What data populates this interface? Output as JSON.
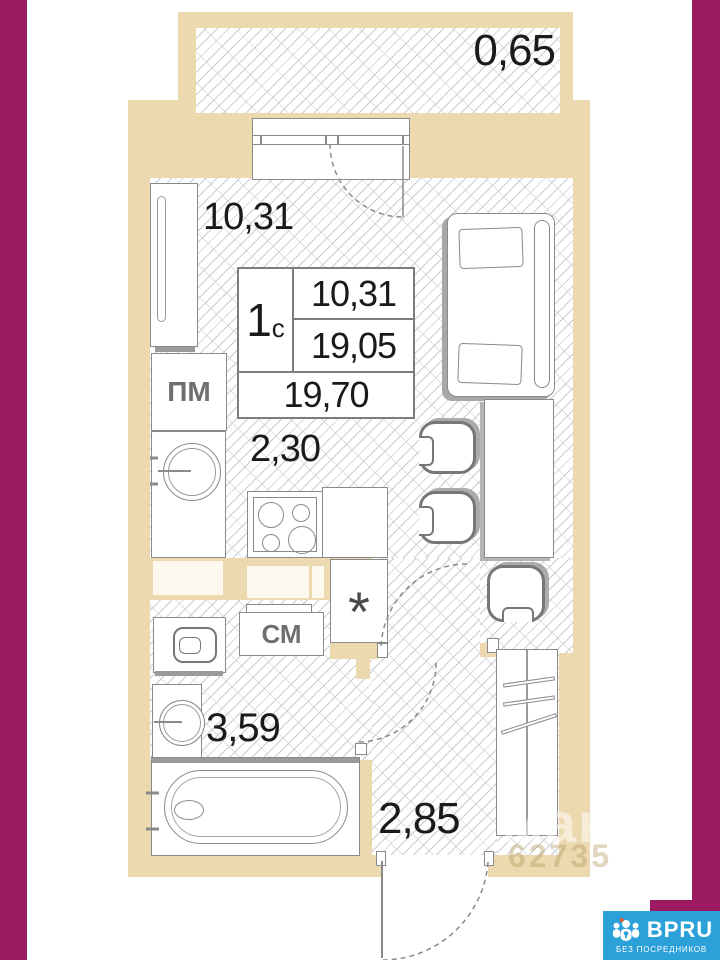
{
  "plan": {
    "balcony_area": "0,65",
    "room_area": "10,31",
    "kitchen_area": "2,30",
    "bathroom_area": "3,59",
    "hallway_area": "2,85",
    "unit_card": {
      "unit_type": "1",
      "unit_type_suffix": "с",
      "room_value": "10,31",
      "living_value": "19,05",
      "total_value": "19,70"
    },
    "marks": {
      "dishwasher": "ПМ",
      "washing_machine": "СМ",
      "closet": "*"
    }
  },
  "watermark": {
    "line1": "мак",
    "line2": "62735"
  },
  "logo": {
    "brand": "BPRU",
    "tagline": "БЕЗ ПОСРЕДНИКОВ"
  },
  "colors": {
    "wall": "#ecd9b0",
    "frame_magenta": "#9c1b60",
    "logo_blue": "#2ba0d9"
  }
}
